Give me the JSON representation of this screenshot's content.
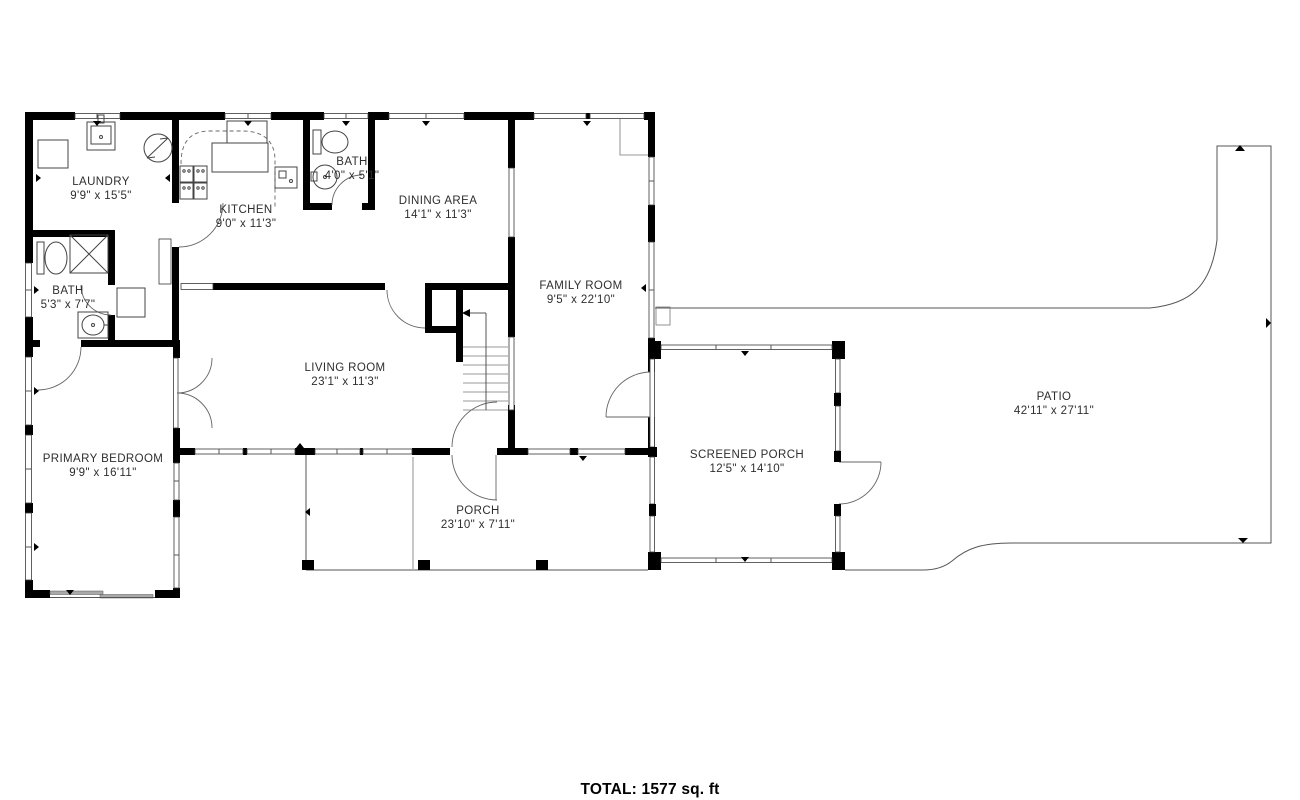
{
  "title": {
    "total_label": "TOTAL: 1577 sq. ft"
  },
  "rooms": [
    {
      "id": "laundry",
      "name": "LAUNDRY",
      "dims": "9'9\" x 15'5\""
    },
    {
      "id": "kitchen",
      "name": "KITCHEN",
      "dims": "9'0\" x 11'3\""
    },
    {
      "id": "bath-upper",
      "name": "BATH",
      "dims": "4'0\" x 5'1\""
    },
    {
      "id": "dining-area",
      "name": "DINING AREA",
      "dims": "14'1\" x 11'3\""
    },
    {
      "id": "family-room",
      "name": "FAMILY ROOM",
      "dims": "9'5\" x 22'10\""
    },
    {
      "id": "bath-left",
      "name": "BATH",
      "dims": "5'3\" x 7'7\""
    },
    {
      "id": "living-room",
      "name": "LIVING ROOM",
      "dims": "23'1\" x 11'3\""
    },
    {
      "id": "primary-bedroom",
      "name": "PRIMARY BEDROOM",
      "dims": "9'9\" x 16'11\""
    },
    {
      "id": "screened-porch",
      "name": "SCREENED PORCH",
      "dims": "12'5\" x 14'10\""
    },
    {
      "id": "porch",
      "name": "PORCH",
      "dims": "23'10\" x 7'11\""
    },
    {
      "id": "patio",
      "name": "PATIO",
      "dims": "42'11\" x 27'11\""
    }
  ],
  "colors": {
    "wall": "#000000",
    "line": "#555555",
    "background": "#ffffff"
  }
}
